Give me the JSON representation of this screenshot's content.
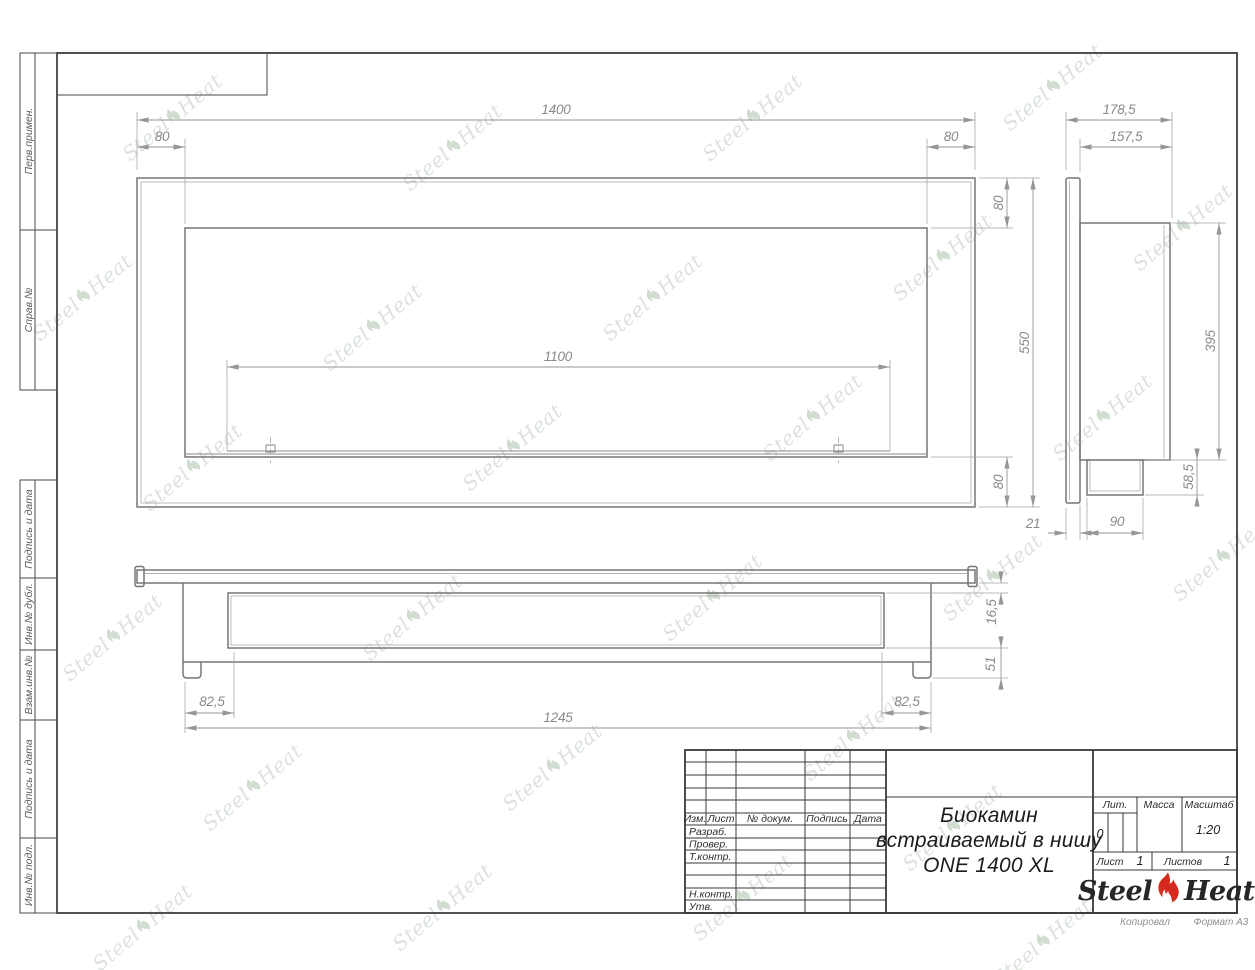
{
  "watermark": {
    "steel": "Steel",
    "heat": "Heat",
    "tiles": [
      [
        180,
        120
      ],
      [
        460,
        150
      ],
      [
        760,
        120
      ],
      [
        1060,
        90
      ],
      [
        90,
        300
      ],
      [
        380,
        330
      ],
      [
        660,
        300
      ],
      [
        950,
        260
      ],
      [
        1190,
        230
      ],
      [
        200,
        470
      ],
      [
        520,
        450
      ],
      [
        820,
        420
      ],
      [
        1110,
        420
      ],
      [
        120,
        640
      ],
      [
        420,
        620
      ],
      [
        720,
        600
      ],
      [
        1000,
        580
      ],
      [
        1230,
        560
      ],
      [
        260,
        790
      ],
      [
        560,
        770
      ],
      [
        860,
        740
      ],
      [
        150,
        930
      ],
      [
        450,
        910
      ],
      [
        750,
        900
      ],
      [
        1050,
        945
      ],
      [
        960,
        830
      ]
    ]
  },
  "margin_labels": {
    "m1": "Перв.примен.",
    "m2": "Справ.№",
    "m3": "Подпись и дата",
    "m4": "Инв.№ дубл.",
    "m5": "Взам.инв.№",
    "m6": "Подпись и дата",
    "m7": "Инв.№ подл."
  },
  "dims": {
    "front": {
      "w": "1400",
      "offl": "80",
      "offr": "80",
      "open": "1100",
      "top": "80",
      "h": "550",
      "bot": "80"
    },
    "side": {
      "depth": "178,5",
      "inner": "157,5",
      "body": "395",
      "notch": "58,5",
      "plate": "21",
      "box": "90"
    },
    "bottom": {
      "lip": "16,5",
      "foot": "51",
      "offl": "82,5",
      "offr": "82,5",
      "base": "1245"
    }
  },
  "title_block": {
    "h_izm": "Изм.",
    "h_list": "Лист",
    "h_doc": "№ докум.",
    "h_sign": "Подпись",
    "h_date": "Дата",
    "r_razrab": "Разраб.",
    "r_prover": "Провер.",
    "r_tkontr": "Т.контр.",
    "r_nkontr": "Н.контр.",
    "r_utv": "Утв.",
    "lit_label": "Лит.",
    "mass_label": "Масса",
    "scale_label": "Масштаб",
    "lit_value": "0",
    "scale_value": "1:20",
    "sheet_label": "Лист",
    "sheet_value": "1",
    "sheets_label": "Листов",
    "sheets_value": "1",
    "name1": "Биокамин",
    "name2": "встраиваемый в нишу",
    "name3": "ONE 1400 XL",
    "logo_steel": "Steel",
    "logo_heat": "Heat",
    "copied_label": "Копировал",
    "format_label": "Формат А3"
  },
  "colors": {
    "flame_red": "#d42b1e",
    "line_gray": "#767676",
    "frame_dark": "#3e3e3e",
    "watermark_green": "#bfcbbf"
  }
}
